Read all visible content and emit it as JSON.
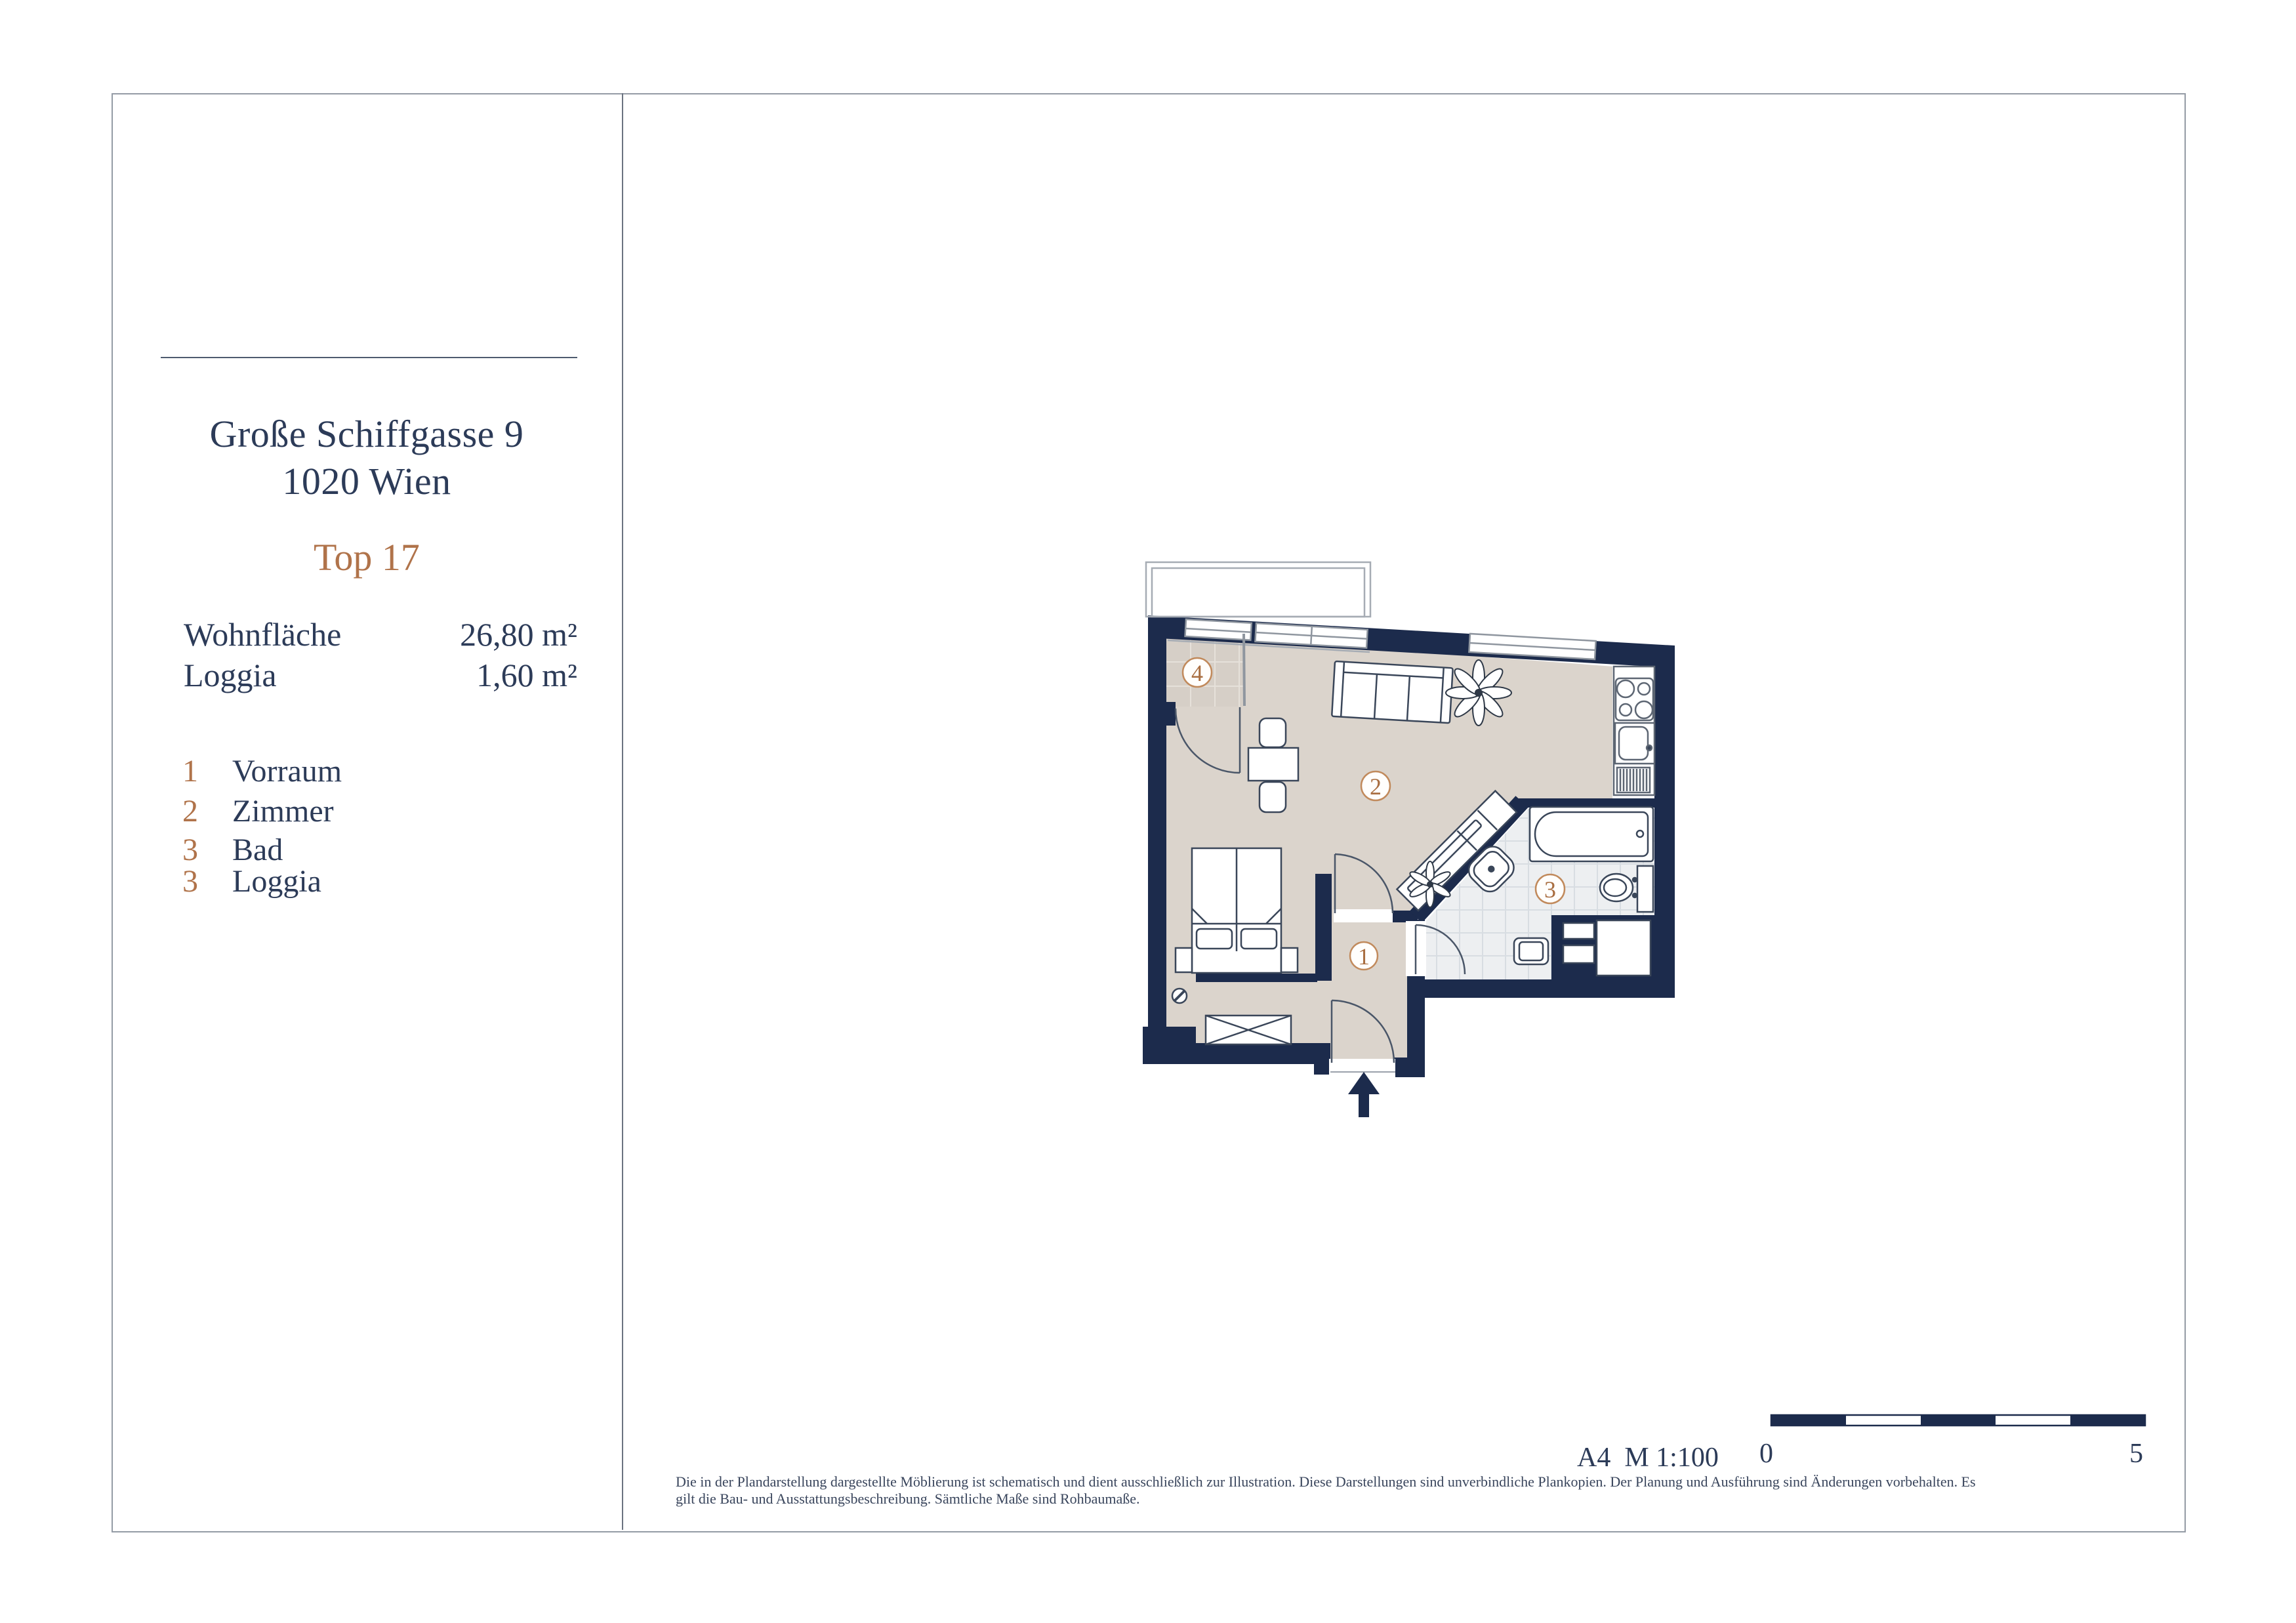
{
  "panel": {
    "address_line1": "Große Schiffgasse 9",
    "address_line2": "1020 Wien",
    "unit_label": "Top 17",
    "area_rows": [
      {
        "label": "Wohnfläche",
        "value": "26,80 m²"
      },
      {
        "label": "Loggia",
        "value": "1,60 m²"
      }
    ],
    "legend": [
      {
        "num": "1",
        "label": "Vorraum"
      },
      {
        "num": "2",
        "label": "Zimmer"
      },
      {
        "num": "3",
        "label": "Bad"
      },
      {
        "num": "3",
        "label": "Loggia"
      }
    ]
  },
  "plan": {
    "rooms": [
      {
        "number": "1",
        "name": "Vorraum"
      },
      {
        "number": "2",
        "name": "Zimmer"
      },
      {
        "number": "3",
        "name": "Bad"
      },
      {
        "number": "4",
        "name": "Loggia"
      }
    ],
    "colors": {
      "wall": "#1c2b4c",
      "floor": "#dbd4cc",
      "loggia_tile": "#d6cfc7",
      "bath_tile": "#edeff1",
      "accent": "#b0734a",
      "text": "#2c3b58"
    }
  },
  "footer": {
    "scale_note": "A4  M 1:100",
    "scale_start": "0",
    "scale_end": "5",
    "disclaimer_line1": "Die in der Plandarstellung dargestellte Möblierung ist schematisch und dient ausschließlich zur Illustration. Diese Darstellungen sind unverbindliche Plankopien. Der Planung und Ausführung sind Änderungen vorbehalten. Es",
    "disclaimer_line2": "gilt die Bau- und Ausstattungsbeschreibung. Sämtliche Maße sind Rohbaumaße."
  }
}
